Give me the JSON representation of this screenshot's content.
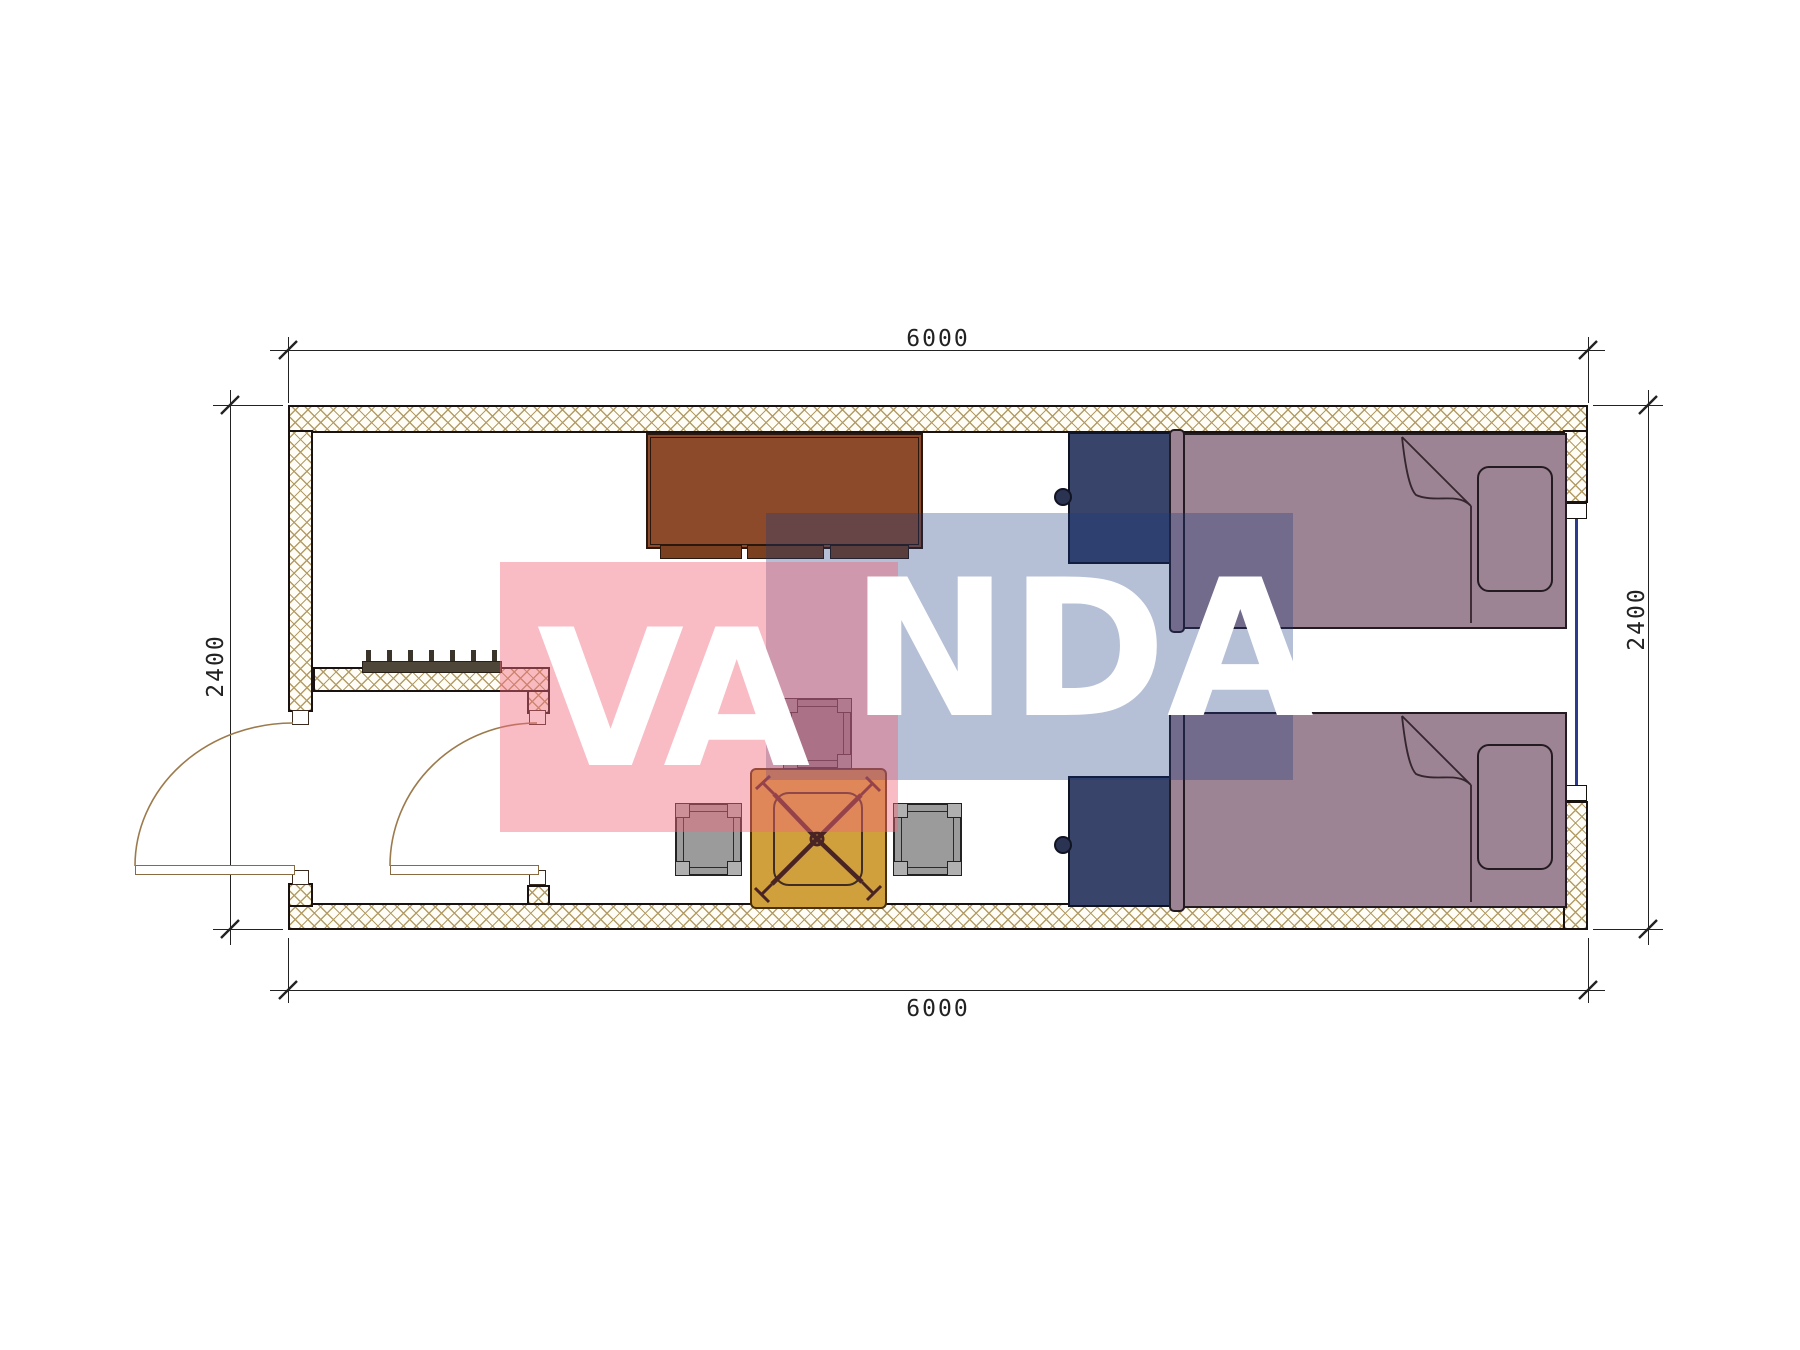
{
  "dimensions": {
    "top": "6000",
    "bottom": "6000",
    "left": "2400",
    "right": "2400"
  },
  "watermark": {
    "left_text": "VA",
    "right_text": "NDA",
    "pink_color": "rgba(242,105,125,0.45)",
    "blue_color": "rgba(25,55,125,0.32)"
  },
  "colors": {
    "wall-border": "#191210",
    "wall-bg": "#fffdf6",
    "hatch": "#b39c66",
    "dim": "#222222",
    "cabinet": "#8c4a2b",
    "wardrobe": "#39446b",
    "bed": "#9c8494",
    "table": "#cfa03c",
    "stool": "#9b9b9b",
    "window": "#2b3b8f",
    "door-arc": "#9c7a4c",
    "wm-pink": "rgba(242,105,125,0.45)",
    "wm-blue": "rgba(25,55,125,0.32)"
  }
}
